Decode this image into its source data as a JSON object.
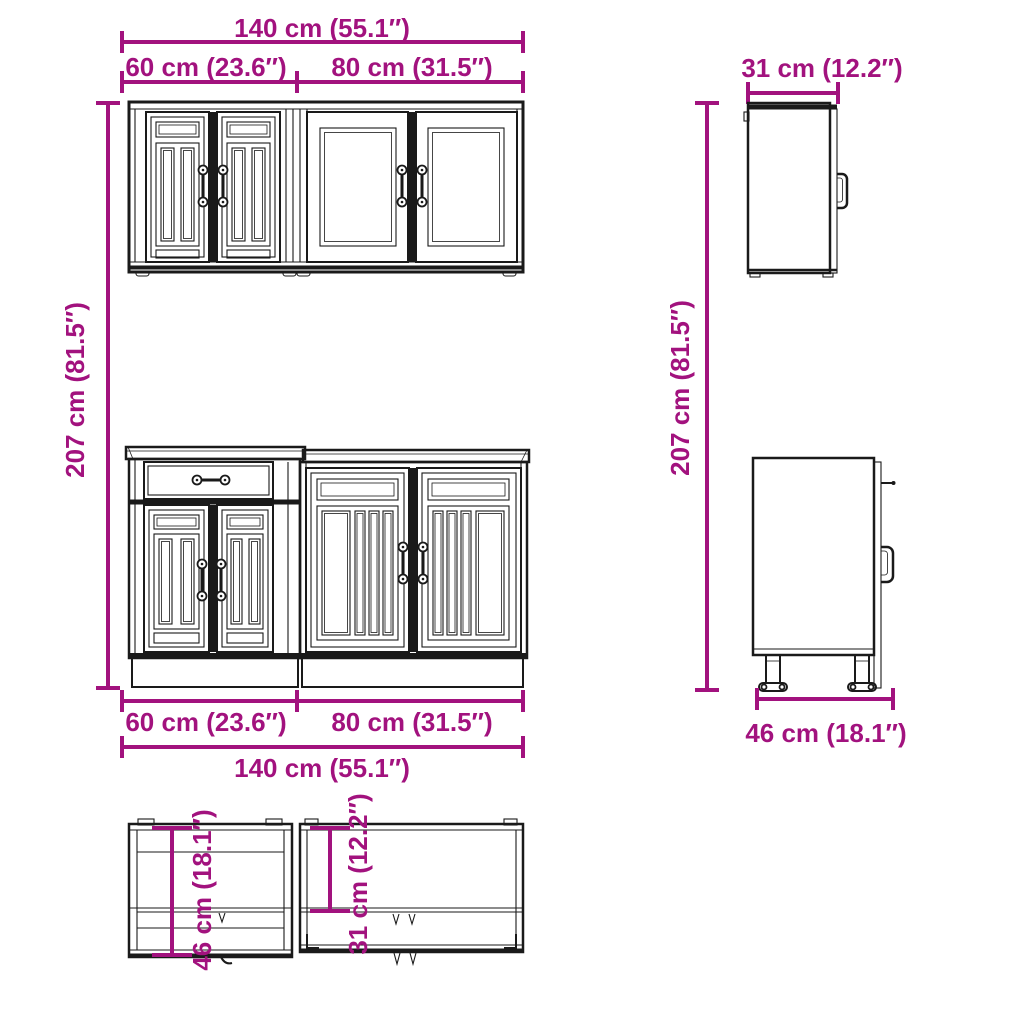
{
  "diagram": {
    "type": "furniture-dimension-diagram",
    "subject": "kitchen cabinet set - front, side and top orthographic views",
    "colors": {
      "dimension_accent": "#A2127E",
      "line_art": "#1A1A1A",
      "background": "#FFFFFF"
    },
    "labels": {
      "top_total_width": "140 cm (55.1″)",
      "top_left_width": "60 cm (23.6″)",
      "top_right_width": "80 cm (31.5″)",
      "left_height": "207 cm (81.5″)",
      "right_height": "207 cm (81.5″)",
      "wall_side_depth": "31 cm (12.2″)",
      "base_side_width": "46 cm (18.1″)",
      "bottom_left_width": "60 cm (23.6″)",
      "bottom_right_width": "80 cm (31.5″)",
      "bottom_total_width": "140 cm (55.1″)",
      "top_view_base_depth": "46 cm (18.1″)",
      "top_view_wall_depth": "31 cm (12.2″)"
    }
  }
}
